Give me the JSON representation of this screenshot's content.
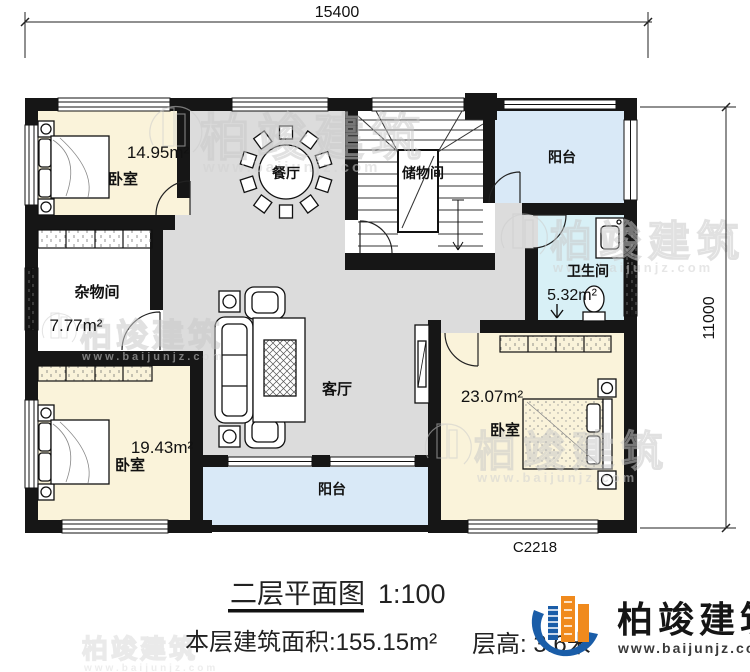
{
  "title_block": {
    "drawing_title": "二层平面图",
    "scale": "1:100",
    "floor_area": "本层建筑面积:155.15m²",
    "floor_height": "层高: 3.6米"
  },
  "dimensions": {
    "width_mm": "15400",
    "height_mm": "11000",
    "window_code": "C2218"
  },
  "rooms": {
    "bedroom_tl": {
      "name": "卧室",
      "area": "14.95m²"
    },
    "dining": {
      "name": "餐厅"
    },
    "stair_storage": {
      "name": "储物间"
    },
    "balcony_top": {
      "name": "阳台"
    },
    "utility": {
      "name": "杂物间",
      "area": "7.77m²"
    },
    "bathroom": {
      "name": "卫生间",
      "area": "5.32m²"
    },
    "living": {
      "name": "客厅"
    },
    "bedroom_bl": {
      "name": "卧室",
      "area": "19.43m²"
    },
    "bedroom_br": {
      "name": "卧室",
      "area": "23.07m²"
    },
    "balcony_bottom": {
      "name": "阳台"
    }
  },
  "branding": {
    "company": "柏竣建筑",
    "website": "www.baijunjz.com"
  },
  "watermark": {
    "company": "柏竣建筑",
    "website": "www.baijunjz.com"
  },
  "colors": {
    "wall": "#161616",
    "bedroom_fill": "#FAF3DA",
    "hall_fill": "#DCDCDC",
    "balcony_fill": "#D9E9F7",
    "bathroom_fill": "#D8F0F6",
    "brand_blue": "#1A5DA8",
    "brand_orange": "#F08A1D"
  }
}
